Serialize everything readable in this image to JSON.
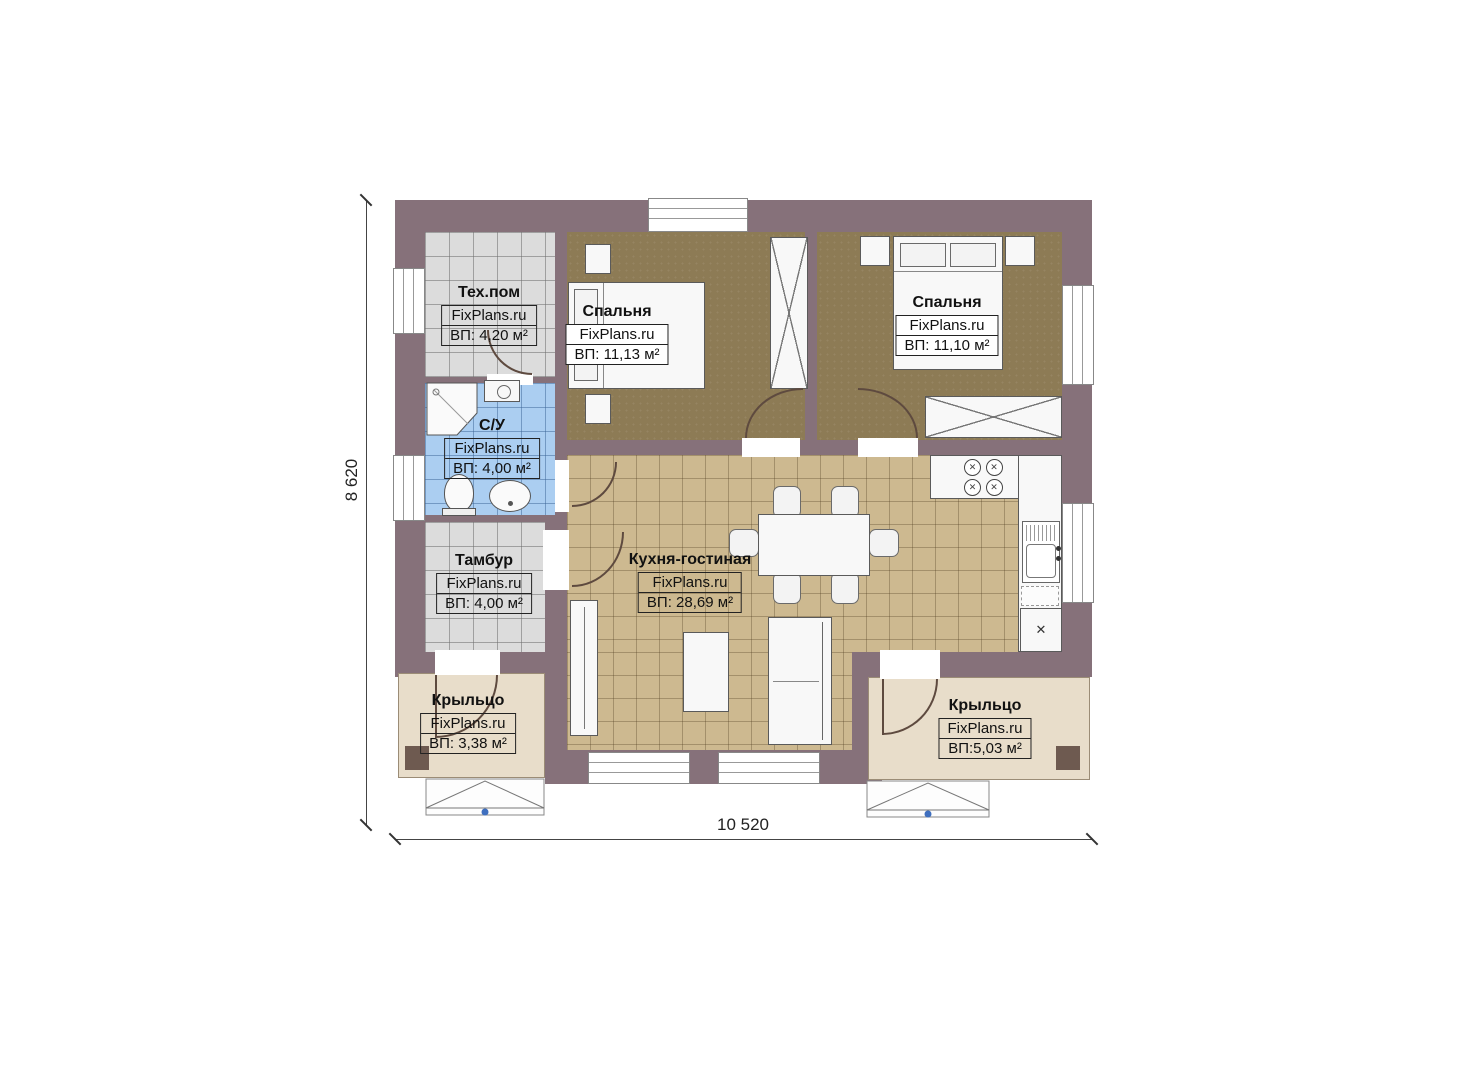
{
  "plan": {
    "rooms": [
      {
        "id": "tech",
        "name": "Тех.пом",
        "brand": "FixPlans.ru",
        "area": "ВП: 4,20 м²"
      },
      {
        "id": "bedroom1",
        "name": "Спальня",
        "brand": "FixPlans.ru",
        "area": "ВП: 11,13 м²"
      },
      {
        "id": "bedroom2",
        "name": "Спальня",
        "brand": "FixPlans.ru",
        "area": "ВП: 11,10 м²"
      },
      {
        "id": "bathroom",
        "name": "С/У",
        "brand": "FixPlans.ru",
        "area": "ВП: 4,00 м²"
      },
      {
        "id": "vestibule",
        "name": "Тамбур",
        "brand": "FixPlans.ru",
        "area": "ВП: 4,00 м²"
      },
      {
        "id": "kitchen-living",
        "name": "Кухня-гостиная",
        "brand": "FixPlans.ru",
        "area": "ВП: 28,69 м²"
      },
      {
        "id": "porch-left",
        "name": "Крыльцо",
        "brand": "FixPlans.ru",
        "area": "ВП: 3,38 м²"
      },
      {
        "id": "porch-right",
        "name": "Крыльцо",
        "brand": "FixPlans.ru",
        "area": "ВП:5,03 м²"
      }
    ],
    "dimensions": {
      "height": "8 620",
      "width": "10 520"
    },
    "colors": {
      "wall": "#86717A",
      "bedroom_floor": "#8D7B55",
      "kitchen_floor": "#CDB990",
      "tile_gray": "#DCDCDC",
      "tile_blue": "#ABCEF1",
      "porch": "#E8DDCA",
      "step_marker": "#3F6FBF"
    }
  }
}
